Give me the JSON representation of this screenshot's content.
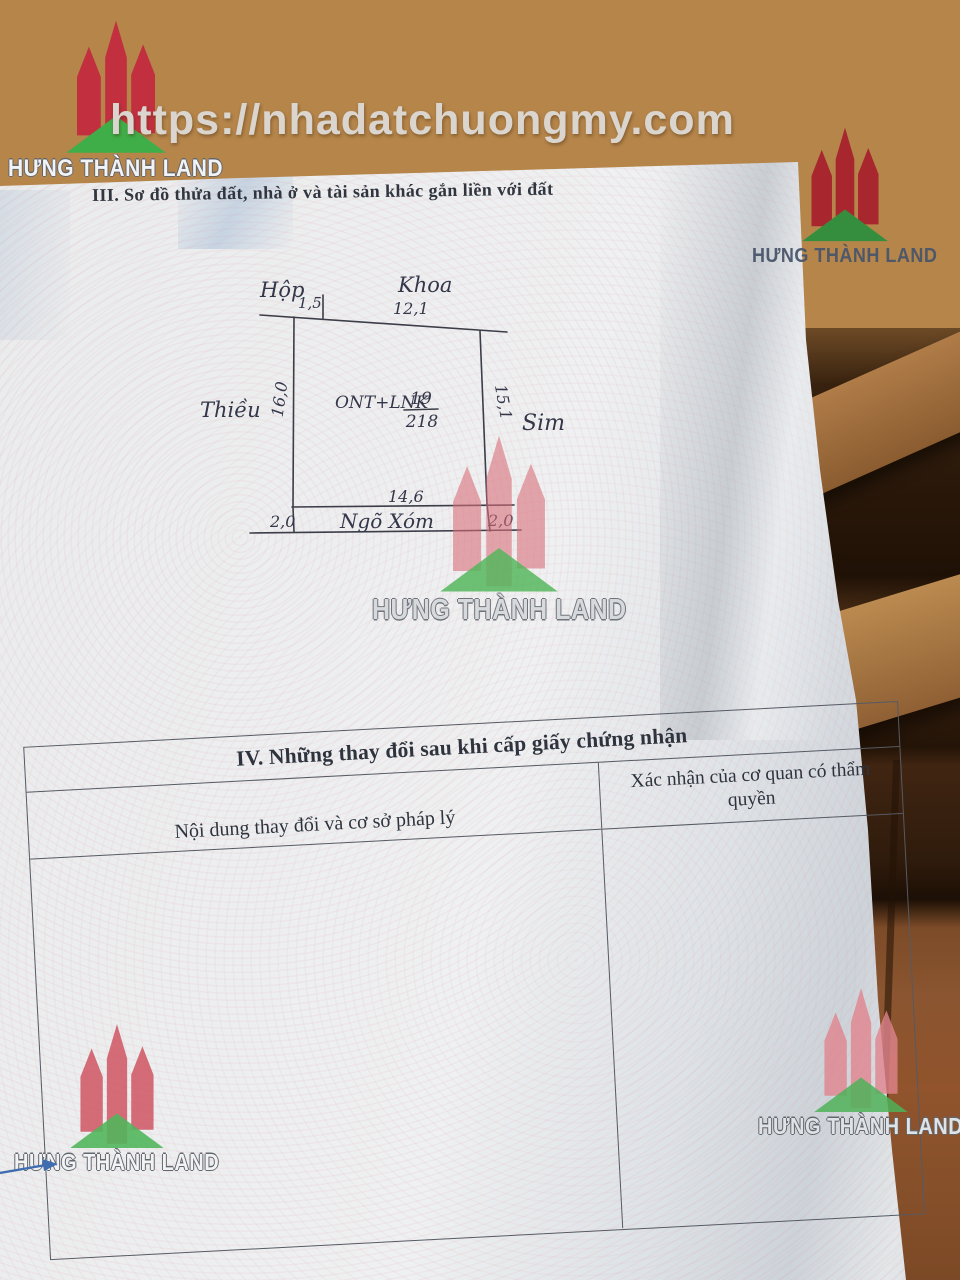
{
  "watermark": {
    "url_text": "https://nhadatchuongmy.com",
    "brand_name": "HƯNG THÀNH LAND",
    "brand_red": "#c23040",
    "brand_green": "#3fae49"
  },
  "document": {
    "section3_heading": "III. Sơ đồ thửa đất, nhà ở và tài sản khác gắn liền với đất"
  },
  "diagram": {
    "neighbor_top_left": "Hộp",
    "dim_top_left": "1,5",
    "neighbor_top": "Khoa",
    "dim_top": "12,1",
    "neighbor_left": "Thiều",
    "dim_left": "16,0",
    "neighbor_right": "Sim",
    "dim_right": "15,1",
    "land_use_label": "ONT+LNK",
    "parcel_number": "19",
    "parcel_area": "218",
    "dim_bottom": "14,6",
    "road_label": "Ngõ Xóm",
    "road_width_left": "2,0",
    "road_width_right": "2,0"
  },
  "section4": {
    "title": "IV. Những thay đổi sau khi cấp giấy chứng nhận",
    "col_left": "Nội dung thay đổi và cơ sở pháp lý",
    "col_right": "Xác nhận của cơ quan có thẩm quyền"
  },
  "icons": {
    "logo_icon": "hung-thanh-land-towers-logo",
    "pen_mark": "blue-pen-arrow"
  }
}
